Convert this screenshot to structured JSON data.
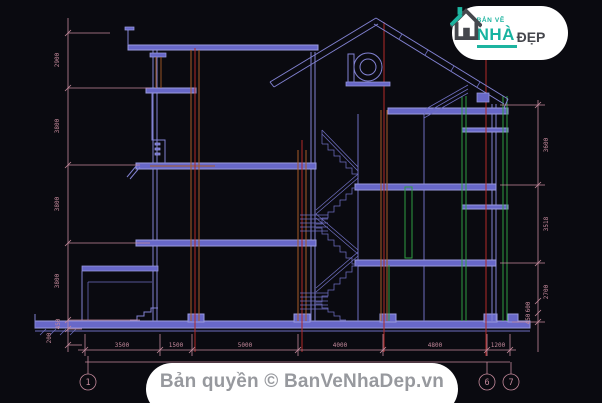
{
  "title": "House cross-section CAD drawing",
  "logo": {
    "top": "BẢN VẼ",
    "name": "NHÀ",
    "suffix": "ĐẸP"
  },
  "footer": {
    "copyright": "Bản quyền © BanVeNhaDep.vn"
  },
  "axis_bubbles": {
    "b1": "1",
    "b6": "6",
    "b7": "7"
  },
  "dimensions": {
    "left": [
      "2900",
      "3800",
      "3800",
      "3800",
      "450",
      "200"
    ],
    "right": [
      "3600",
      "3518",
      "2700",
      "600",
      "450"
    ],
    "bottom": [
      "3500",
      "1500",
      "5000",
      "4000",
      "4800",
      "1200"
    ]
  },
  "colors": {
    "background": "#0a0a10",
    "cad_line": "#8282d2",
    "slab_fill": "#6868c8",
    "dimension": "#c4899b",
    "grid_red": "#b22a28",
    "accent_orange": "#a85c28",
    "accent_green": "#2f9e42",
    "logo_teal": "#1db4a0",
    "logo_gray": "#45474d",
    "watermark_text": "#97999e"
  }
}
